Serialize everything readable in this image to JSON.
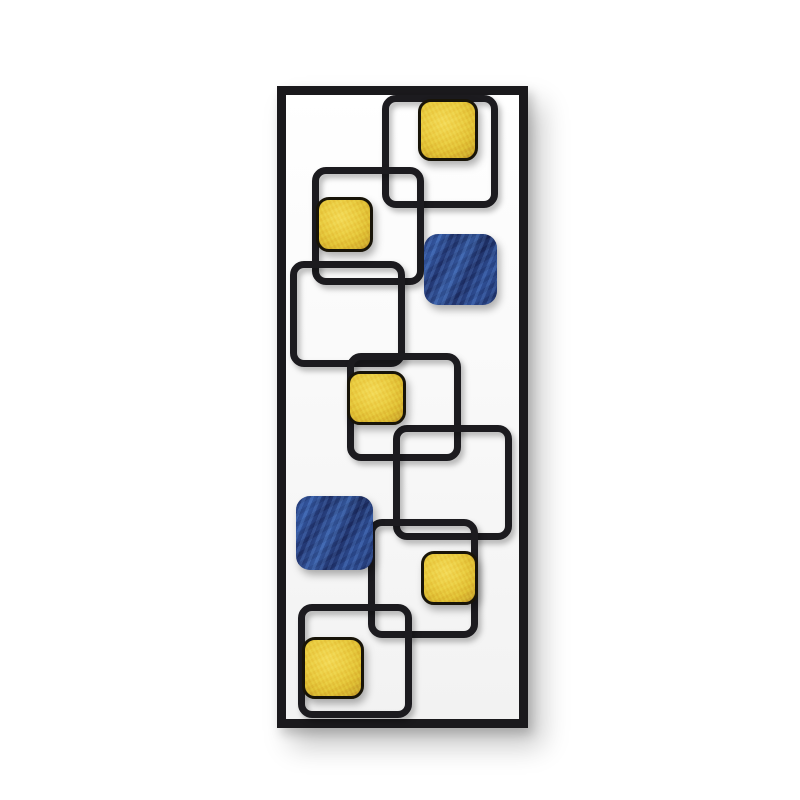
{
  "meta": {
    "description": "Product photograph of a modern metal wall art sculpture: a tall rectangular black frame enclosing interlocking open wire squares with gold-leaf and blue painted square panels, on a plain white studio background with a soft drop shadow.",
    "background_color": "#ffffff"
  },
  "artwork": {
    "frame": {
      "x": 277,
      "y": 86,
      "width": 251,
      "height": 642,
      "thickness": 9
    },
    "style": {
      "frame_color": "#1a191c",
      "outline_color": "#1c1b1f",
      "outline_thickness": 7,
      "gold_light": "#f2d654",
      "gold_mid": "#e7c63e",
      "gold_base": "#dcb832",
      "gold_dark": "#bd9428",
      "gold_border": "#181408",
      "blue_base": "#24397a",
      "blue_stroke_light": "#4c80d2",
      "blue_stroke_dark": "#16204e"
    },
    "outline_squares": [
      {
        "x": 382,
        "y": 95,
        "width": 116,
        "height": 113
      },
      {
        "x": 312,
        "y": 167,
        "width": 112,
        "height": 118
      },
      {
        "x": 290,
        "y": 261,
        "width": 115,
        "height": 106
      },
      {
        "x": 347,
        "y": 353,
        "width": 114,
        "height": 108
      },
      {
        "x": 393,
        "y": 425,
        "width": 119,
        "height": 115
      },
      {
        "x": 368,
        "y": 519,
        "width": 110,
        "height": 119
      },
      {
        "x": 298,
        "y": 604,
        "width": 114,
        "height": 114
      }
    ],
    "filled_squares": [
      {
        "type": "gold",
        "x": 418,
        "y": 99,
        "width": 60,
        "height": 62
      },
      {
        "type": "gold",
        "x": 316,
        "y": 197,
        "width": 57,
        "height": 55
      },
      {
        "type": "blue",
        "x": 424,
        "y": 234,
        "width": 73,
        "height": 71
      },
      {
        "type": "gold",
        "x": 347,
        "y": 371,
        "width": 59,
        "height": 54
      },
      {
        "type": "blue",
        "x": 296,
        "y": 496,
        "width": 77,
        "height": 74
      },
      {
        "type": "gold",
        "x": 421,
        "y": 551,
        "width": 57,
        "height": 54
      },
      {
        "type": "gold",
        "x": 302,
        "y": 637,
        "width": 62,
        "height": 62
      }
    ]
  }
}
